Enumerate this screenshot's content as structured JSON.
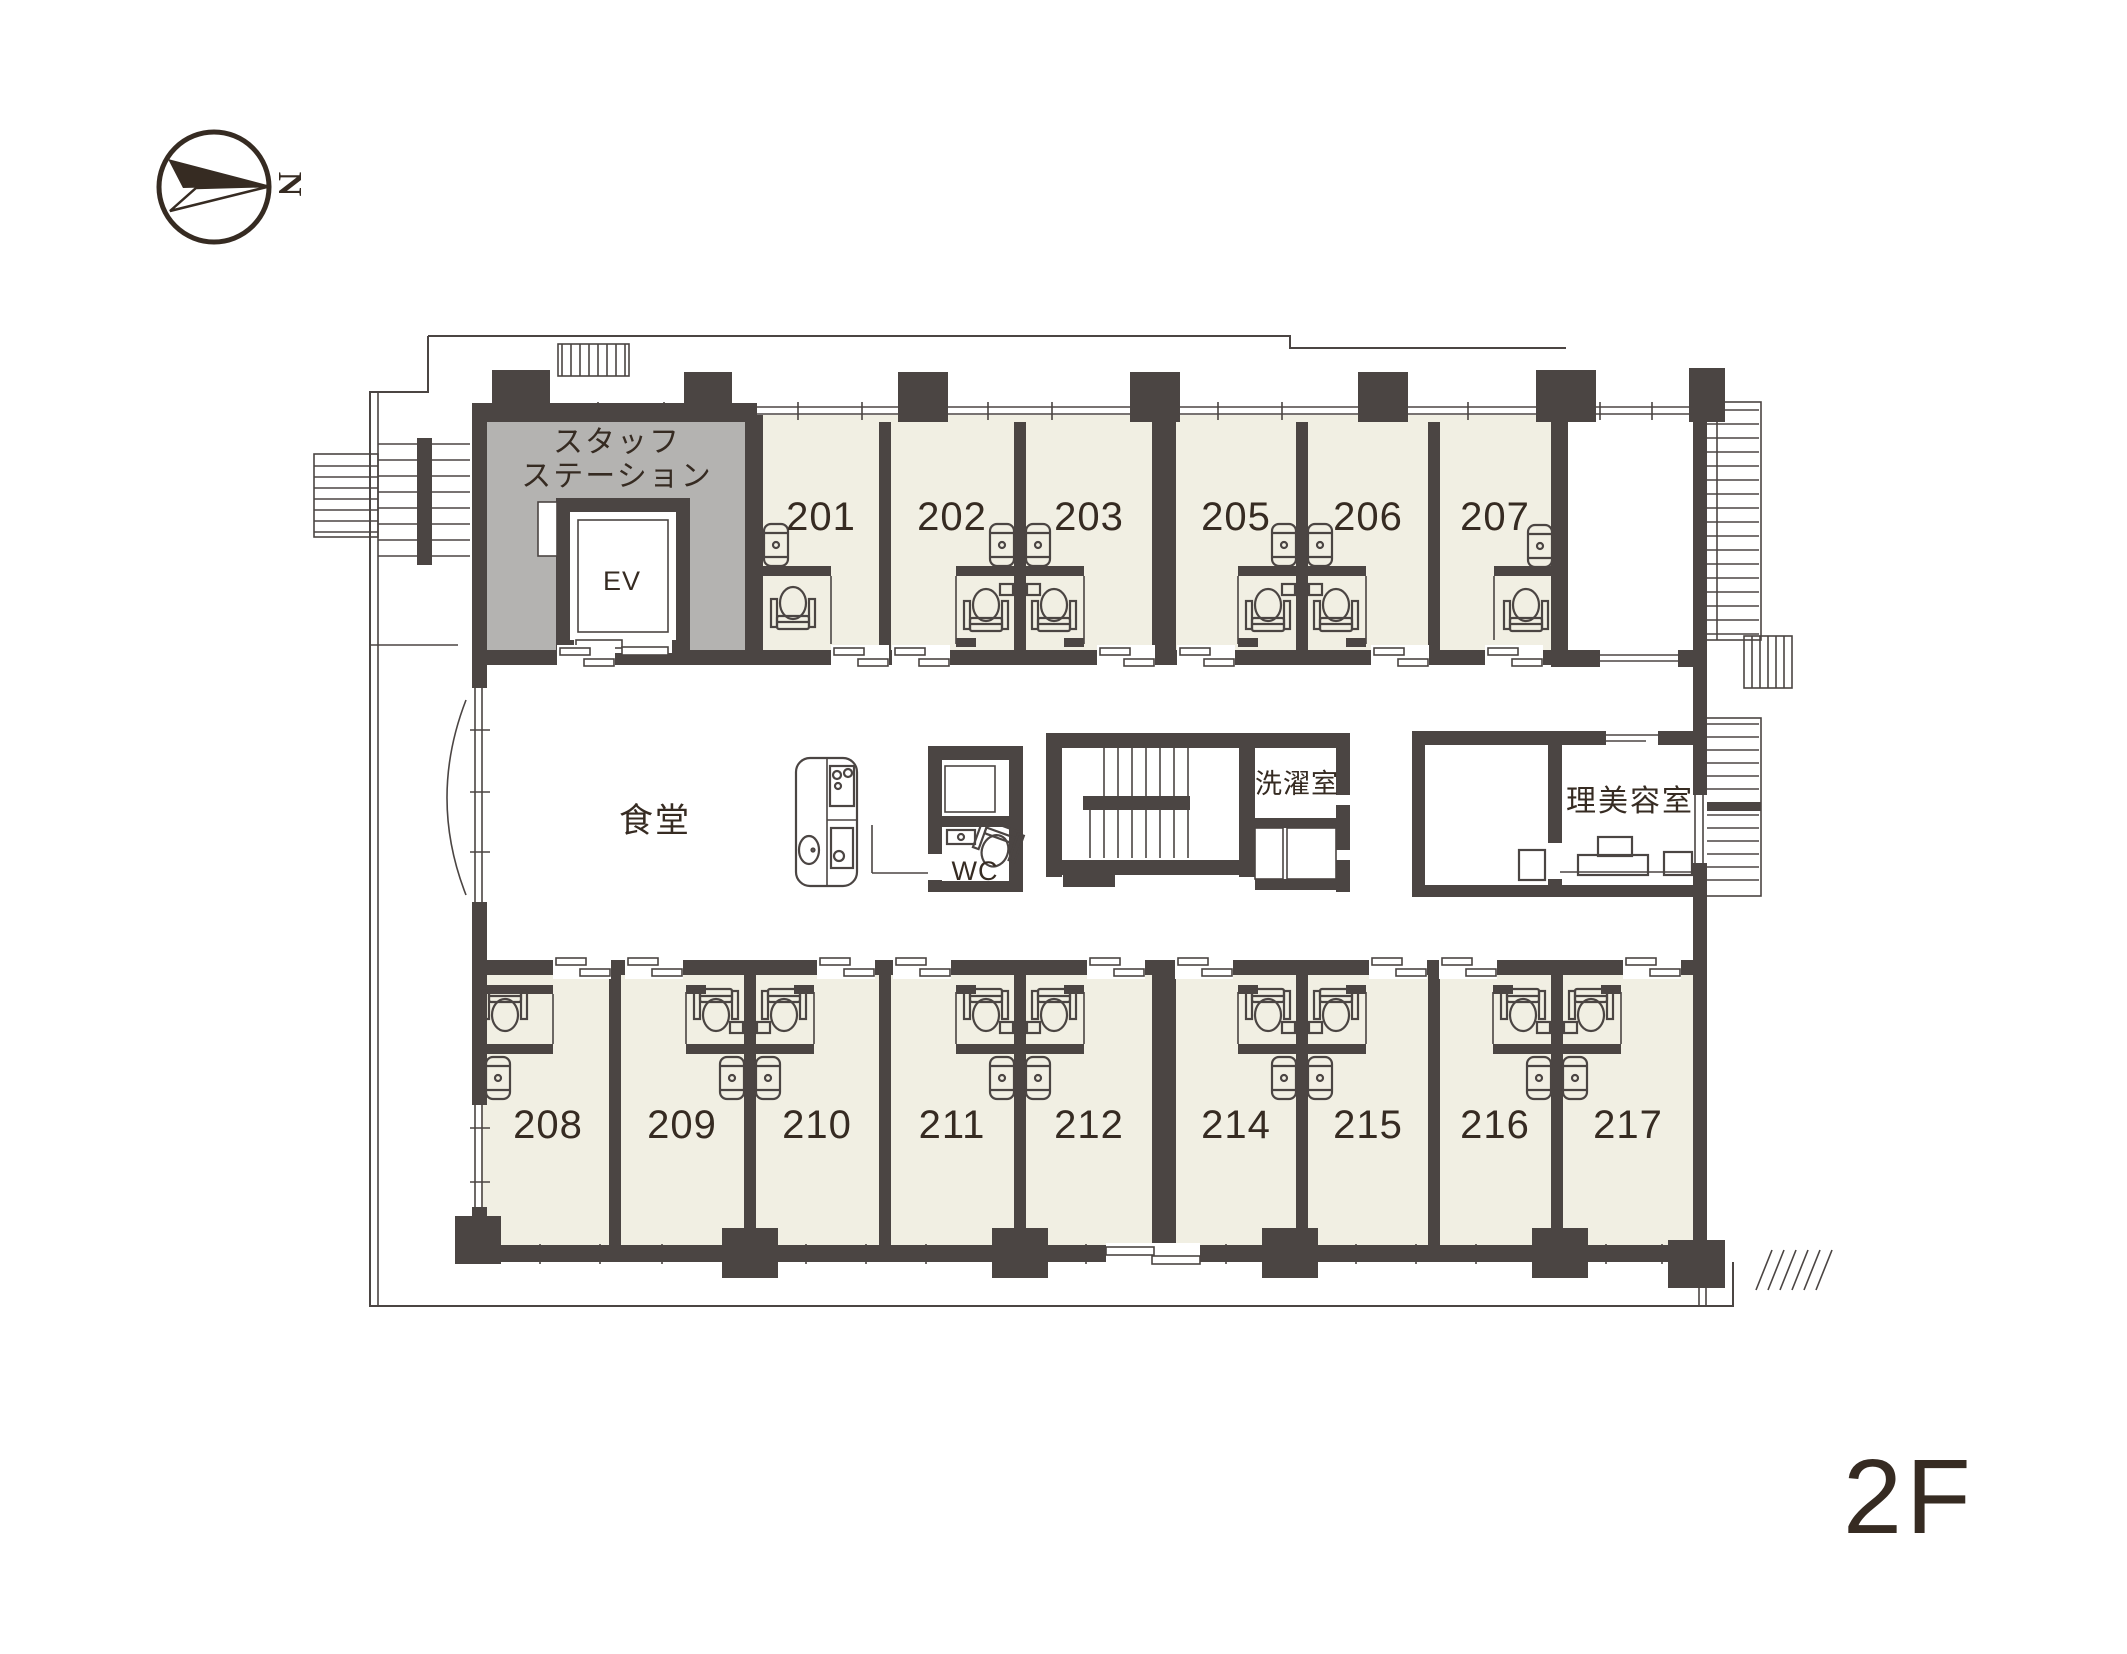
{
  "compass": {
    "north_label": "N"
  },
  "floor_badge": "2F",
  "rooms": {
    "top": [
      "201",
      "202",
      "203",
      "205",
      "206",
      "207"
    ],
    "bottom": [
      "208",
      "209",
      "210",
      "211",
      "212",
      "214",
      "215",
      "216",
      "217"
    ]
  },
  "areas": {
    "staff_station": [
      "スタッフ",
      "ステーション"
    ],
    "elevator": "EV",
    "dining": "食堂",
    "toilet": "WC",
    "laundry": "洗濯室",
    "beauty_salon": "理美容室"
  },
  "icons": {
    "compass": "north-arrow-icon",
    "toilet": "toilet-plan-icon",
    "washbasin": "washbasin-plan-icon",
    "kitchen": "kitchen-counter-icon",
    "stairs": "stairs-icon"
  },
  "colors": {
    "wall": "#4b4543",
    "room_fill": "#f1efe3",
    "staff_station_fill": "#b4b3b1",
    "floor_badge": "#a69048",
    "label_text": "#362b22",
    "background": "#ffffff"
  }
}
